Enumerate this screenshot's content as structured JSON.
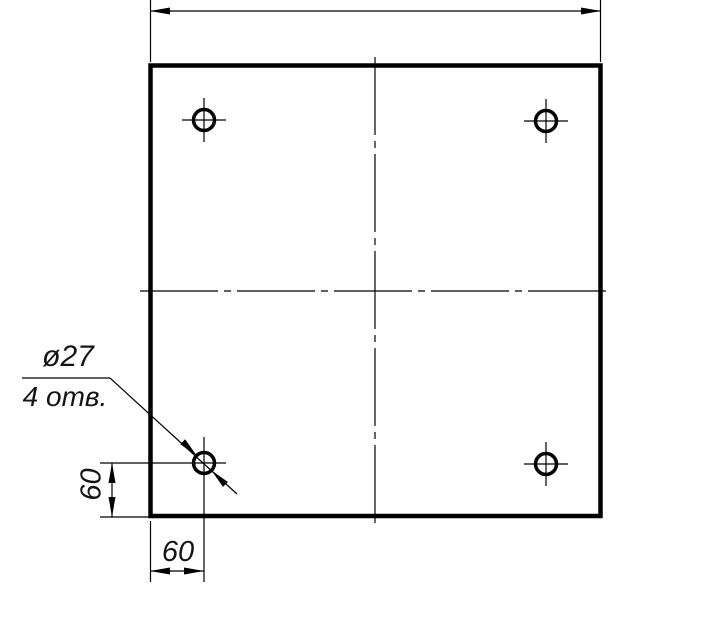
{
  "labels": {
    "hole_diameter": "ø27",
    "hole_count": "4 отв.",
    "left_offset": "60",
    "bottom_offset": "60"
  },
  "colors": {
    "background": "#ffffff",
    "line": "#000000",
    "text": "#141414"
  },
  "drawing": {
    "canvas": {
      "width": 713,
      "height": 631
    },
    "line_weights": {
      "thick": 4.5,
      "thin": 1.2,
      "hole": 3.5
    },
    "plate": {
      "x": 150.5,
      "y": 65.5,
      "width": 450,
      "height": 450.5
    },
    "centerlines": {
      "dash": "78 6 7 6",
      "horizontal": {
        "y": 291,
        "x1": 140,
        "x2": 612
      },
      "vertical": {
        "x": 375,
        "y1": 57,
        "y2": 526
      }
    },
    "holes": {
      "radius": 10.5,
      "items": [
        {
          "name": "hole-top-left",
          "cx": 204,
          "cy": 120,
          "h": [
            182,
            226
          ],
          "v": [
            98,
            142
          ]
        },
        {
          "name": "hole-top-right",
          "cx": 546,
          "cy": 121,
          "h": [
            524,
            568
          ],
          "v": [
            99,
            143
          ]
        },
        {
          "name": "hole-bottom-left",
          "cx": 204,
          "cy": 463,
          "h": [
            100,
            226
          ],
          "v": [
            437,
            582
          ]
        },
        {
          "name": "hole-bottom-right",
          "cx": 546,
          "cy": 464,
          "h": [
            524,
            568
          ],
          "v": [
            442,
            486
          ]
        }
      ]
    },
    "arrow": {
      "length": 20,
      "half_width": 3.5
    },
    "dimensions": [
      {
        "name": "dim-top-width",
        "line": [
          150,
          11,
          601,
          11
        ],
        "extensions": [
          [
            150.5,
            0,
            150.5,
            62
          ],
          [
            600.5,
            0,
            600.5,
            62
          ]
        ],
        "arrows": [
          [
            150,
            11,
            180
          ],
          [
            601,
            11,
            0
          ]
        ]
      },
      {
        "name": "dim-left-60",
        "line": [
          112,
          463,
          112,
          517
        ],
        "extensions": [
          [
            100,
            517,
            150,
            517
          ]
        ],
        "arrows": [
          [
            112,
            463,
            270
          ],
          [
            112,
            517,
            90
          ]
        ]
      },
      {
        "name": "dim-bottom-60",
        "line": [
          150,
          571,
          204,
          571
        ],
        "extensions": [
          [
            150.5,
            521,
            150.5,
            582
          ]
        ],
        "arrows": [
          [
            150,
            571,
            180
          ],
          [
            204,
            571,
            0
          ]
        ]
      }
    ],
    "leader": {
      "shelf": [
        22,
        378,
        110,
        378
      ],
      "line": [
        110,
        378,
        237,
        494
      ],
      "arrows": [
        [
          196.8,
          455.8,
          45
        ],
        [
          211.3,
          470.3,
          225
        ]
      ]
    }
  }
}
